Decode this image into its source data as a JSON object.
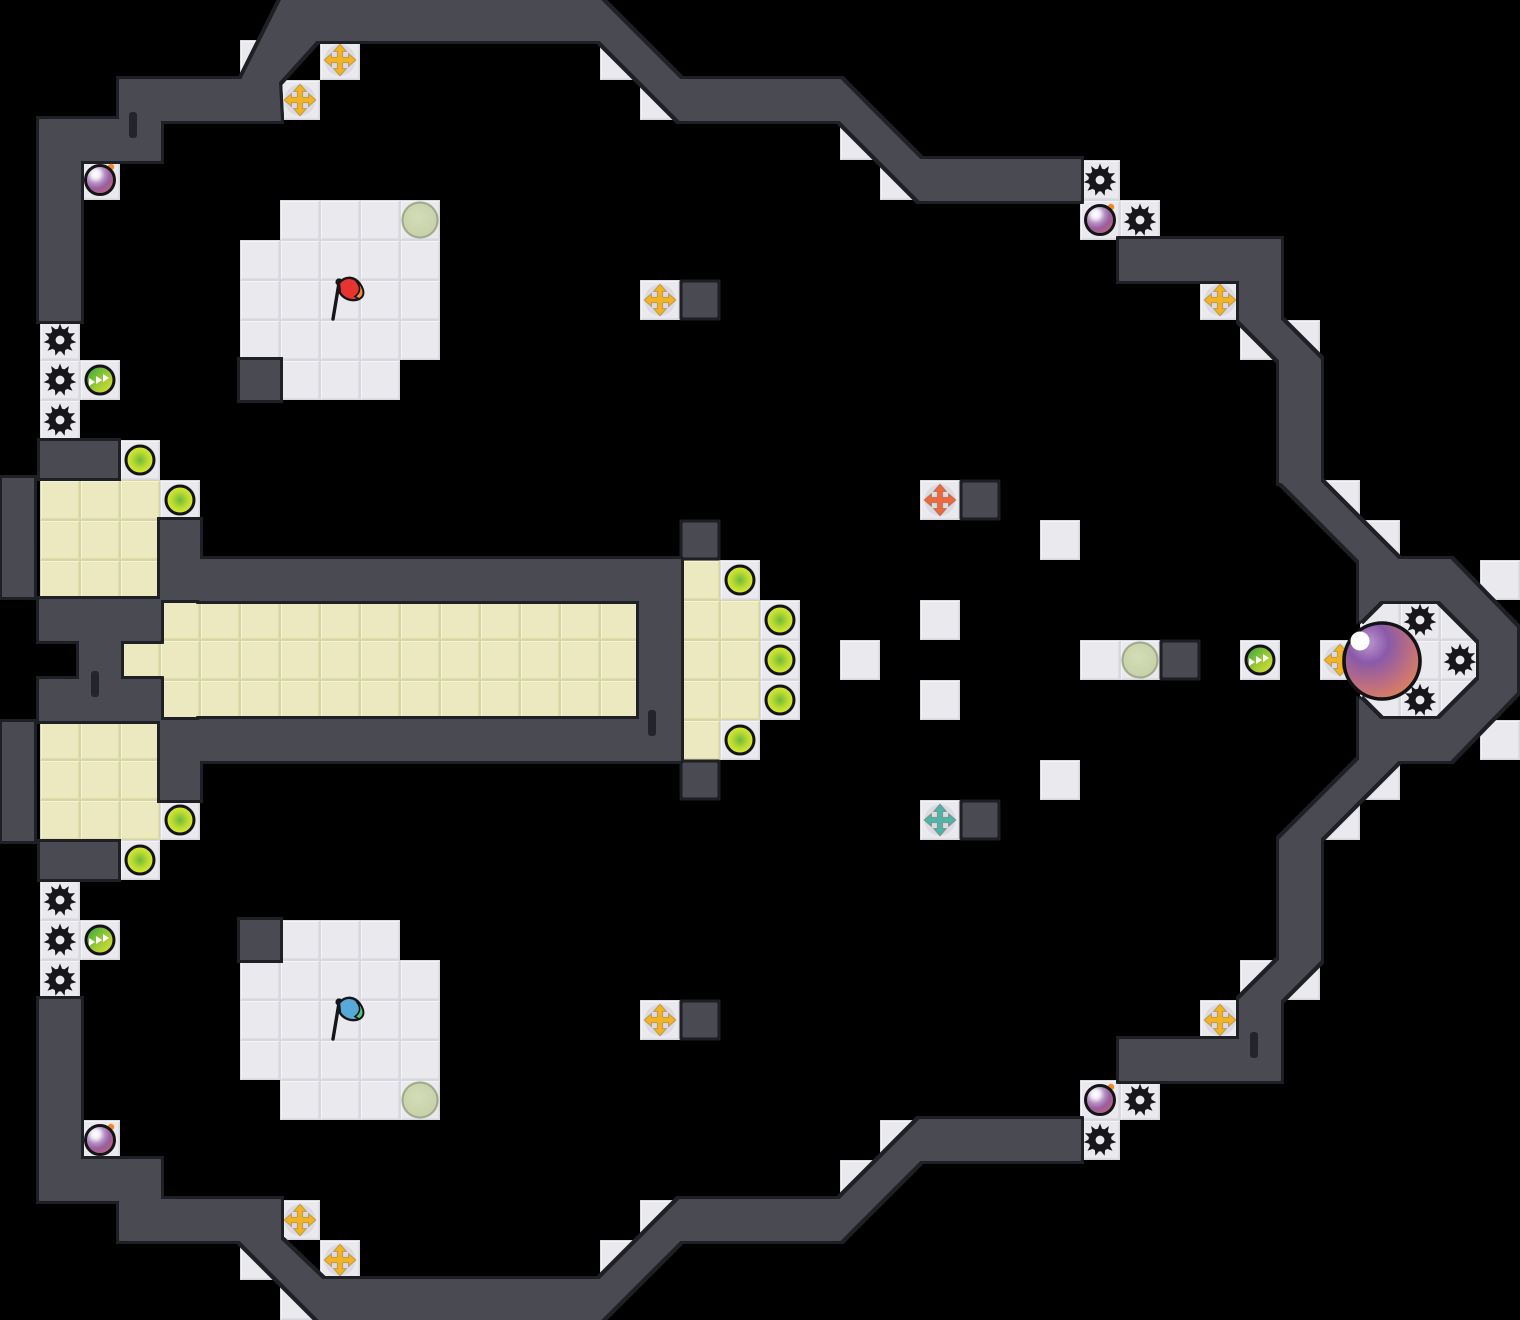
{
  "board": {
    "width": 1520,
    "height": 1320,
    "tile_size": 40,
    "background": "#000000"
  },
  "colors": {
    "wall_fill": "#4a4a52",
    "wall_outline": "#1f1f26",
    "wall_notch": "#24242b",
    "floor": "#e9e9ee",
    "floor_edge": "#d8d8df",
    "team_tile": "#ece9c0",
    "team_tile_edge": "#d9d6a6",
    "spike": "#17171b",
    "bomb_purple": "#9a5d9e",
    "bomb_pink": "#c4646e",
    "bomb_spark": "#f5871f",
    "yellow_ball_edge": "#ecf432",
    "yellow_ball_center": "#6abc3a",
    "green_powerup_a": "#2fa23c",
    "green_powerup_b": "#e3e52e",
    "gold_cross": "#f2b324",
    "orange_cross": "#ed6a3f",
    "teal_cross": "#53b3a8",
    "spawn_circle_fill": "#ccd6ad",
    "spawn_circle_edge": "#a2ac8c",
    "red_flag": "#e83430",
    "red_flag_tip": "#f09030",
    "blue_flag": "#58a8d8",
    "blue_flag_tip": "#50c880",
    "ball_purple": "#8a5aa8",
    "ball_orange": "#ee8848",
    "icon_outline": "#141418"
  },
  "floors": [
    [
      7,
      0
    ],
    [
      6,
      1
    ],
    [
      8,
      1
    ],
    [
      15,
      1
    ],
    [
      7,
      2
    ],
    [
      16,
      2
    ],
    [
      21,
      3
    ],
    [
      2,
      4
    ],
    [
      22,
      4
    ],
    [
      27,
      4
    ],
    [
      7,
      5
    ],
    [
      8,
      5
    ],
    [
      9,
      5
    ],
    [
      10,
      5
    ],
    [
      27,
      5
    ],
    [
      28,
      5
    ],
    [
      6,
      6
    ],
    [
      7,
      6
    ],
    [
      8,
      6
    ],
    [
      9,
      6
    ],
    [
      10,
      6
    ],
    [
      6,
      7
    ],
    [
      7,
      7
    ],
    [
      8,
      7
    ],
    [
      9,
      7
    ],
    [
      10,
      7
    ],
    [
      16,
      7
    ],
    [
      30,
      7
    ],
    [
      1,
      8
    ],
    [
      6,
      8
    ],
    [
      7,
      8
    ],
    [
      8,
      8
    ],
    [
      9,
      8
    ],
    [
      10,
      8
    ],
    [
      31,
      8
    ],
    [
      32,
      8
    ],
    [
      1,
      9
    ],
    [
      2,
      9
    ],
    [
      7,
      9
    ],
    [
      8,
      9
    ],
    [
      9,
      9
    ],
    [
      1,
      10
    ],
    [
      3,
      11
    ],
    [
      4,
      12
    ],
    [
      23,
      12
    ],
    [
      33,
      12
    ],
    [
      26,
      13
    ],
    [
      34,
      13
    ],
    [
      18,
      14
    ],
    [
      37,
      14
    ],
    [
      19,
      15
    ],
    [
      23,
      15
    ],
    [
      34,
      15
    ],
    [
      35,
      15
    ],
    [
      36,
      15
    ],
    [
      19,
      16
    ],
    [
      21,
      16
    ],
    [
      27,
      16
    ],
    [
      28,
      16
    ],
    [
      31,
      16
    ],
    [
      33,
      16
    ],
    [
      34,
      16
    ],
    [
      35,
      16
    ],
    [
      36,
      16
    ],
    [
      19,
      17
    ],
    [
      23,
      17
    ],
    [
      34,
      17
    ],
    [
      35,
      17
    ],
    [
      36,
      17
    ],
    [
      18,
      18
    ],
    [
      37,
      18
    ],
    [
      26,
      19
    ],
    [
      34,
      19
    ],
    [
      4,
      20
    ],
    [
      23,
      20
    ],
    [
      33,
      20
    ],
    [
      3,
      21
    ],
    [
      1,
      22
    ],
    [
      1,
      23
    ],
    [
      2,
      23
    ],
    [
      7,
      23
    ],
    [
      8,
      23
    ],
    [
      9,
      23
    ],
    [
      1,
      24
    ],
    [
      6,
      24
    ],
    [
      7,
      24
    ],
    [
      8,
      24
    ],
    [
      9,
      24
    ],
    [
      10,
      24
    ],
    [
      31,
      24
    ],
    [
      32,
      24
    ],
    [
      6,
      25
    ],
    [
      7,
      25
    ],
    [
      8,
      25
    ],
    [
      9,
      25
    ],
    [
      10,
      25
    ],
    [
      16,
      25
    ],
    [
      30,
      25
    ],
    [
      6,
      26
    ],
    [
      7,
      26
    ],
    [
      8,
      26
    ],
    [
      9,
      26
    ],
    [
      10,
      26
    ],
    [
      7,
      27
    ],
    [
      8,
      27
    ],
    [
      9,
      27
    ],
    [
      10,
      27
    ],
    [
      27,
      27
    ],
    [
      28,
      27
    ],
    [
      2,
      28
    ],
    [
      22,
      28
    ],
    [
      27,
      28
    ],
    [
      21,
      29
    ],
    [
      7,
      30
    ],
    [
      16,
      30
    ],
    [
      6,
      31
    ],
    [
      8,
      31
    ],
    [
      15,
      31
    ],
    [
      7,
      32
    ]
  ],
  "yellow_rects": [
    [
      1,
      12,
      3,
      3
    ],
    [
      1,
      18,
      3,
      3
    ],
    [
      4,
      15,
      12,
      3
    ]
  ],
  "yellow_tiles": [
    [
      3,
      16
    ],
    [
      17,
      14
    ],
    [
      17,
      15
    ],
    [
      17,
      16
    ],
    [
      17,
      17
    ],
    [
      17,
      18
    ],
    [
      18,
      15
    ],
    [
      18,
      16
    ],
    [
      18,
      17
    ]
  ],
  "walls": {
    "polygons": [
      [
        [
          40,
          320
        ],
        [
          40,
          120
        ],
        [
          120,
          120
        ],
        [
          120,
          80
        ],
        [
          242,
          80
        ],
        [
          282,
          0
        ],
        [
          600,
          0
        ],
        [
          680,
          80
        ],
        [
          840,
          80
        ],
        [
          920,
          160
        ],
        [
          1080,
          160
        ],
        [
          1080,
          200
        ],
        [
          920,
          200
        ],
        [
          840,
          120
        ],
        [
          680,
          120
        ],
        [
          600,
          40
        ],
        [
          316,
          40
        ],
        [
          278,
          82
        ],
        [
          280,
          120
        ],
        [
          160,
          120
        ],
        [
          160,
          160
        ],
        [
          80,
          160
        ],
        [
          80,
          320
        ]
      ],
      [
        [
          40,
          600
        ],
        [
          160,
          600
        ],
        [
          160,
          640
        ],
        [
          120,
          640
        ],
        [
          120,
          680
        ],
        [
          160,
          680
        ],
        [
          160,
          720
        ],
        [
          40,
          720
        ],
        [
          40,
          680
        ],
        [
          80,
          680
        ],
        [
          80,
          640
        ],
        [
          40,
          640
        ]
      ],
      [
        [
          200,
          560
        ],
        [
          680,
          560
        ],
        [
          680,
          760
        ],
        [
          200,
          760
        ],
        [
          200,
          720
        ],
        [
          640,
          720
        ],
        [
          640,
          600
        ],
        [
          200,
          600
        ]
      ],
      [
        [
          1120,
          240
        ],
        [
          1280,
          240
        ],
        [
          1280,
          320
        ],
        [
          1320,
          360
        ],
        [
          1320,
          482
        ],
        [
          1398,
          560
        ],
        [
          1450,
          560
        ],
        [
          1516,
          628
        ],
        [
          1516,
          692
        ],
        [
          1450,
          760
        ],
        [
          1398,
          760
        ],
        [
          1320,
          838
        ],
        [
          1320,
          960
        ],
        [
          1280,
          1000
        ],
        [
          1280,
          1080
        ],
        [
          1120,
          1080
        ],
        [
          1120,
          1040
        ],
        [
          1240,
          1040
        ],
        [
          1240,
          1000
        ],
        [
          1280,
          960
        ],
        [
          1280,
          840
        ],
        [
          1360,
          760
        ],
        [
          1360,
          700
        ],
        [
          1380,
          720
        ],
        [
          1440,
          720
        ],
        [
          1480,
          680
        ],
        [
          1480,
          640
        ],
        [
          1440,
          600
        ],
        [
          1380,
          600
        ],
        [
          1360,
          620
        ],
        [
          1360,
          560
        ],
        [
          1282,
          482
        ],
        [
          1280,
          482
        ],
        [
          1280,
          360
        ],
        [
          1240,
          320
        ],
        [
          1240,
          280
        ],
        [
          1120,
          280
        ]
      ],
      [
        [
          40,
          1000
        ],
        [
          40,
          1200
        ],
        [
          120,
          1200
        ],
        [
          120,
          1240
        ],
        [
          240,
          1240
        ],
        [
          320,
          1320
        ],
        [
          600,
          1320
        ],
        [
          680,
          1240
        ],
        [
          840,
          1240
        ],
        [
          920,
          1160
        ],
        [
          1080,
          1160
        ],
        [
          1080,
          1120
        ],
        [
          920,
          1120
        ],
        [
          840,
          1200
        ],
        [
          680,
          1200
        ],
        [
          600,
          1280
        ],
        [
          322,
          1280
        ],
        [
          280,
          1240
        ],
        [
          280,
          1200
        ],
        [
          160,
          1200
        ],
        [
          160,
          1160
        ],
        [
          80,
          1160
        ],
        [
          80,
          1000
        ]
      ]
    ],
    "rects": [
      [
        40,
        441,
        78,
        37
      ],
      [
        40,
        842,
        78,
        37
      ],
      [
        2,
        478,
        32,
        119
      ],
      [
        2,
        722,
        32,
        119
      ],
      [
        160,
        520,
        40,
        80
      ],
      [
        160,
        720,
        40,
        80
      ]
    ],
    "blocks_inset": [
      [
        17,
        7
      ],
      [
        24,
        12
      ],
      [
        17,
        13
      ],
      [
        29,
        16
      ],
      [
        17,
        19
      ],
      [
        24,
        20
      ],
      [
        17,
        25
      ]
    ],
    "blocks_full": [
      [
        6,
        9
      ],
      [
        6,
        23
      ]
    ],
    "notches": [
      [
        129,
        112
      ],
      [
        91,
        671
      ],
      [
        648,
        710
      ],
      [
        1250,
        1032
      ]
    ]
  },
  "objects": {
    "spikes": [
      [
        1,
        8
      ],
      [
        1,
        9
      ],
      [
        1,
        10
      ],
      [
        27,
        4
      ],
      [
        28,
        5
      ],
      [
        35,
        15
      ],
      [
        36,
        16
      ],
      [
        35,
        17
      ],
      [
        1,
        22
      ],
      [
        1,
        23
      ],
      [
        1,
        24
      ],
      [
        28,
        27
      ],
      [
        27,
        28
      ]
    ],
    "bombs": [
      [
        2,
        4
      ],
      [
        27,
        5
      ],
      [
        2,
        28
      ],
      [
        27,
        27
      ]
    ],
    "yellow_balls": [
      [
        3,
        11
      ],
      [
        4,
        12
      ],
      [
        18,
        14
      ],
      [
        19,
        15
      ],
      [
        19,
        16
      ],
      [
        19,
        17
      ],
      [
        18,
        18
      ],
      [
        4,
        20
      ],
      [
        3,
        21
      ]
    ],
    "green_powerups": [
      [
        2,
        9
      ],
      [
        31,
        16
      ],
      [
        2,
        23
      ]
    ],
    "gold_crosses": [
      [
        8,
        1
      ],
      [
        7,
        2
      ],
      [
        16,
        7
      ],
      [
        30,
        7
      ],
      [
        33,
        16
      ],
      [
        16,
        25
      ],
      [
        30,
        25
      ],
      [
        7,
        30
      ],
      [
        8,
        31
      ]
    ],
    "orange_crosses": [
      [
        23,
        12
      ]
    ],
    "teal_crosses": [
      [
        23,
        20
      ]
    ],
    "spawn_circles": [
      [
        10,
        5
      ],
      [
        28,
        16
      ],
      [
        10,
        27
      ]
    ],
    "flags": [
      {
        "col": 8,
        "row": 7,
        "color": "red"
      },
      {
        "col": 8,
        "row": 25,
        "color": "blue"
      }
    ],
    "big_ball": {
      "x": 1382,
      "y": 661,
      "r": 38
    }
  }
}
